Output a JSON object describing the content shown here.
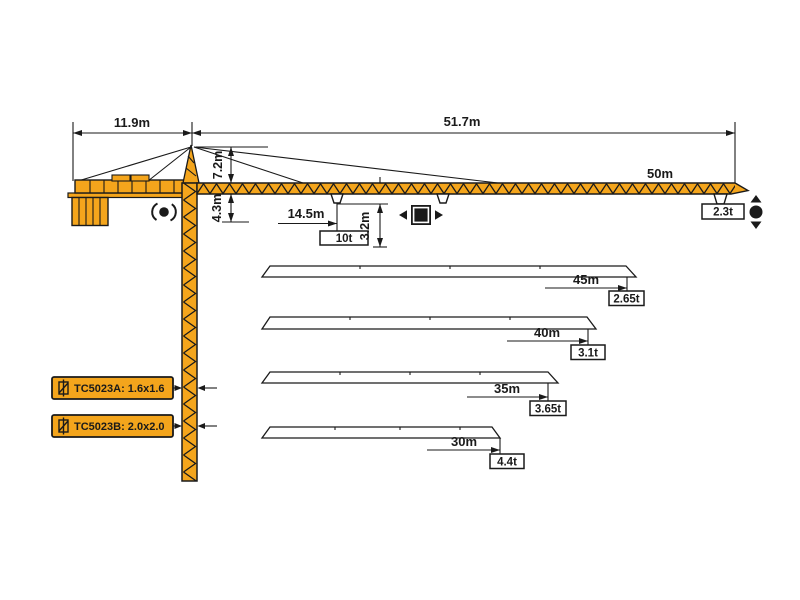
{
  "colors": {
    "crane_orange": "#F4A51C",
    "line_black": "#1A1A1A",
    "background": "#FFFFFF"
  },
  "top_dimensions": {
    "counter_jib": "11.9m",
    "main_jib": "51.7m"
  },
  "side_dimensions": {
    "tower_head": "7.2m",
    "jib_underside": "4.3m",
    "min_radius": "14.5m",
    "hook_drop": "3.2m"
  },
  "max_capacity": "10t",
  "main_jib": {
    "length": "50m",
    "tip_load": "2.3t"
  },
  "jib_variants": [
    {
      "length": "45m",
      "tip_load": "2.65t"
    },
    {
      "length": "40m",
      "tip_load": "3.1t"
    },
    {
      "length": "35m",
      "tip_load": "3.65t"
    },
    {
      "length": "30m",
      "tip_load": "4.4t"
    }
  ],
  "mast_options": [
    {
      "label": "TC5023A: 1.6x1.6"
    },
    {
      "label": "TC5023B: 2.0x2.0"
    }
  ],
  "symbols": {
    "slewing": "slewing-rotation",
    "trolley": "trolley-travel",
    "hoist": "hoist-up-down"
  }
}
